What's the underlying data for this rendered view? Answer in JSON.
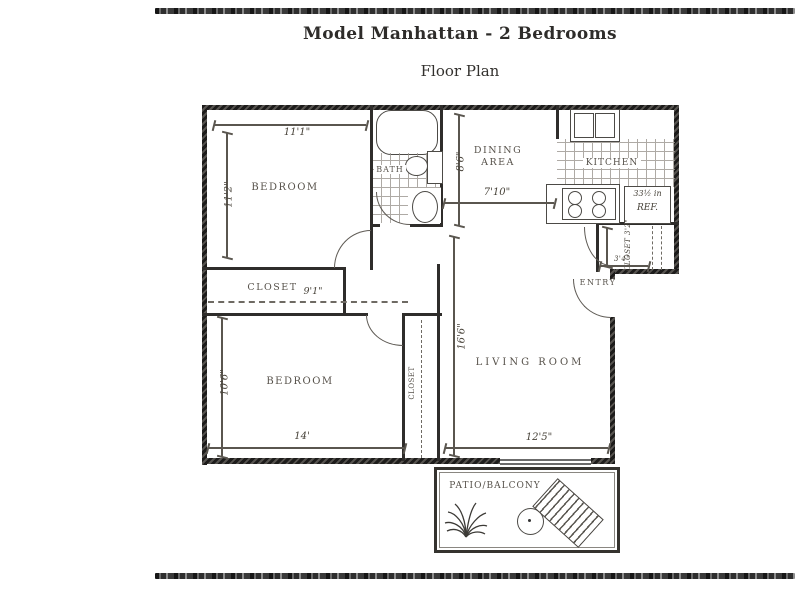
{
  "header": {
    "title": "Model Manhattan - 2 Bedrooms",
    "subtitle": "Floor Plan"
  },
  "plan": {
    "bedroom_top": {
      "label": "BEDROOM",
      "width": "11'1\"",
      "depth": "11'2\""
    },
    "bedroom_bottom": {
      "label": "BEDROOM",
      "width": "14'",
      "depth": "10'6\""
    },
    "bath": {
      "label": "BATH"
    },
    "dining": {
      "label_line1": "DINING",
      "label_line2": "AREA",
      "width": "7'10\"",
      "depth": "8'6\""
    },
    "kitchen": {
      "label": "KITCHEN"
    },
    "refrigerator": {
      "size": "33½ in",
      "label": "REF."
    },
    "hall_closet": {
      "label": "CLOSET",
      "width": "9'1\""
    },
    "corner_closet": {
      "label": "CLOSET 3'2\"",
      "width": "3'4\""
    },
    "bedroom_closet": {
      "label": "CLOSET"
    },
    "entry": {
      "label": "ENTRY"
    },
    "living": {
      "label": "LIVING ROOM",
      "width": "12'5\"",
      "depth": "16'6\""
    },
    "patio": {
      "label": "PATIO/BALCONY"
    }
  },
  "colors": {
    "wall": "#2f2d2b",
    "line": "#5a564f",
    "label": "#57524b",
    "paper": "#ffffff"
  }
}
